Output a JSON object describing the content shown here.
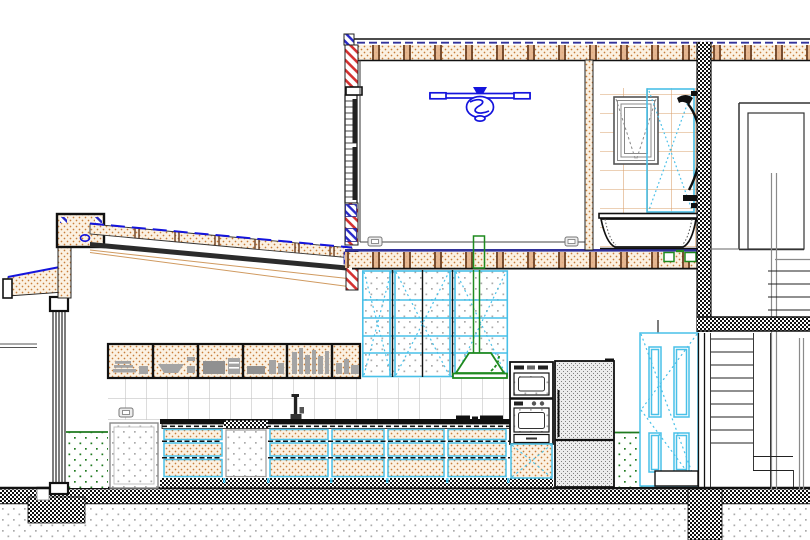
{
  "scene": {
    "kind": "architectural-section-drawing",
    "visible_text": [],
    "notes": "CAD building cross-section: single-storey kitchen wing with shed roof at left, two-storey volume with fan room and bathroom above, stair hall behind party wall at right, hatched ground slab and footings below"
  },
  "palette": {
    "ink": "#1a1a1a",
    "fan_blue": "#1414dd",
    "navy": "#32329a",
    "accent_cyan": "#49c0e8",
    "hood_green": "#1f8a1f",
    "green_dot": "#1f7a1f",
    "hatch_red": "#d43030",
    "hatch_blue": "#2828c8",
    "stipple_bg": "#fbf1e2",
    "stipple_dot": "#c97e3a",
    "joist_wood": "#6b3d1e",
    "joist_fill": "#e2b088",
    "tile_line": "#c6c6c6",
    "bath_tile_line": "#d9a06b",
    "soil_dot": "#ababab",
    "fridge_dot": "#808080",
    "gray": "#8a8a8a",
    "rafter_tan": "#d09a60"
  },
  "symbols": {
    "ceiling_fan": "ceiling-fan-icon",
    "wall_outlet": "power-outlet-icon",
    "range_hood": "range-hood-icon",
    "cooktop": "cooktop-burners-icon",
    "faucet": "sink-faucet-icon",
    "bathtub": "bathtub-icon",
    "shower": "shower-set-icon",
    "fridge": "refrigerator-icon",
    "oven_stack": "double-wall-oven-icon",
    "paneled_door": "four-panel-door-icon",
    "stairs": "stair-treads-icon"
  },
  "legend": {
    "tan_stipple": "timber/insulation section",
    "red_diagonal_hatch": "masonry section",
    "checkerboard": "concrete / party wall section",
    "cyan_lines": "joinery and glazing",
    "green_dots": "fixture zones",
    "soil_dots": "earth below slab"
  }
}
